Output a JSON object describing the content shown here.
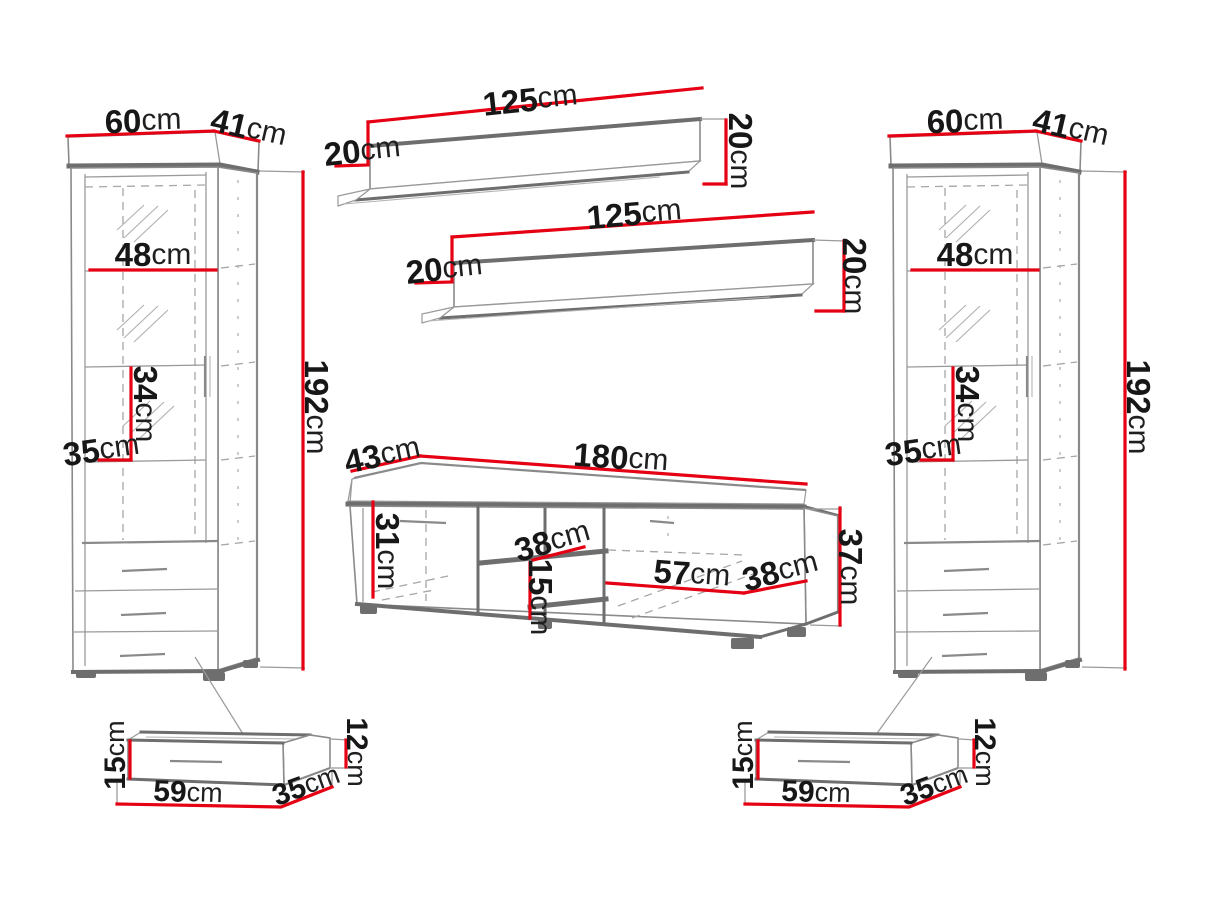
{
  "diagram": {
    "title": "Wall unit furniture set — dimension drawing",
    "unit": "cm",
    "colors": {
      "dimension_line": "#e60013",
      "furniture_outline": "#6e6e6e",
      "furniture_line_light": "#9a9a9a",
      "label_text": "#171717",
      "background": "#ffffff"
    },
    "pieces": {
      "left_cabinet": {
        "name": "Tall display cabinet (left)",
        "width": {
          "value": "60",
          "unit": "cm"
        },
        "depth": {
          "value": "41",
          "unit": "cm"
        },
        "inner_width": {
          "value": "48",
          "unit": "cm"
        },
        "shelf_spacing": {
          "value": "34",
          "unit": "cm"
        },
        "inner_depth": {
          "value": "35",
          "unit": "cm"
        },
        "height": {
          "value": "192",
          "unit": "cm"
        }
      },
      "top_shelf": {
        "name": "Wall shelf (upper)",
        "length": {
          "value": "125",
          "unit": "cm"
        },
        "depth": {
          "value": "20",
          "unit": "cm"
        },
        "height": {
          "value": "20",
          "unit": "cm"
        }
      },
      "middle_shelf": {
        "name": "Wall shelf (lower)",
        "length": {
          "value": "125",
          "unit": "cm"
        },
        "depth": {
          "value": "20",
          "unit": "cm"
        },
        "height": {
          "value": "20",
          "unit": "cm"
        }
      },
      "tv_stand": {
        "name": "TV stand",
        "depth": {
          "value": "43",
          "unit": "cm"
        },
        "width": {
          "value": "180",
          "unit": "cm"
        },
        "inner_height": {
          "value": "31",
          "unit": "cm"
        },
        "niche_width": {
          "value": "38",
          "unit": "cm"
        },
        "niche_height": {
          "value": "15",
          "unit": "cm"
        },
        "compartment_width": {
          "value": "57",
          "unit": "cm"
        },
        "side_depth": {
          "value": "38",
          "unit": "cm"
        },
        "height": {
          "value": "37",
          "unit": "cm"
        }
      },
      "right_cabinet": {
        "name": "Tall display cabinet (right)",
        "width": {
          "value": "60",
          "unit": "cm"
        },
        "depth": {
          "value": "41",
          "unit": "cm"
        },
        "inner_width": {
          "value": "48",
          "unit": "cm"
        },
        "shelf_spacing": {
          "value": "34",
          "unit": "cm"
        },
        "inner_depth": {
          "value": "35",
          "unit": "cm"
        },
        "height": {
          "value": "192",
          "unit": "cm"
        }
      },
      "left_drawer": {
        "name": "Under-cabinet drawer (left)",
        "front_height": {
          "value": "15",
          "unit": "cm"
        },
        "width": {
          "value": "59",
          "unit": "cm"
        },
        "depth": {
          "value": "35",
          "unit": "cm"
        },
        "side_height": {
          "value": "12",
          "unit": "cm"
        }
      },
      "right_drawer": {
        "name": "Under-cabinet drawer (right)",
        "front_height": {
          "value": "15",
          "unit": "cm"
        },
        "width": {
          "value": "59",
          "unit": "cm"
        },
        "depth": {
          "value": "35",
          "unit": "cm"
        },
        "side_height": {
          "value": "12",
          "unit": "cm"
        }
      }
    }
  }
}
